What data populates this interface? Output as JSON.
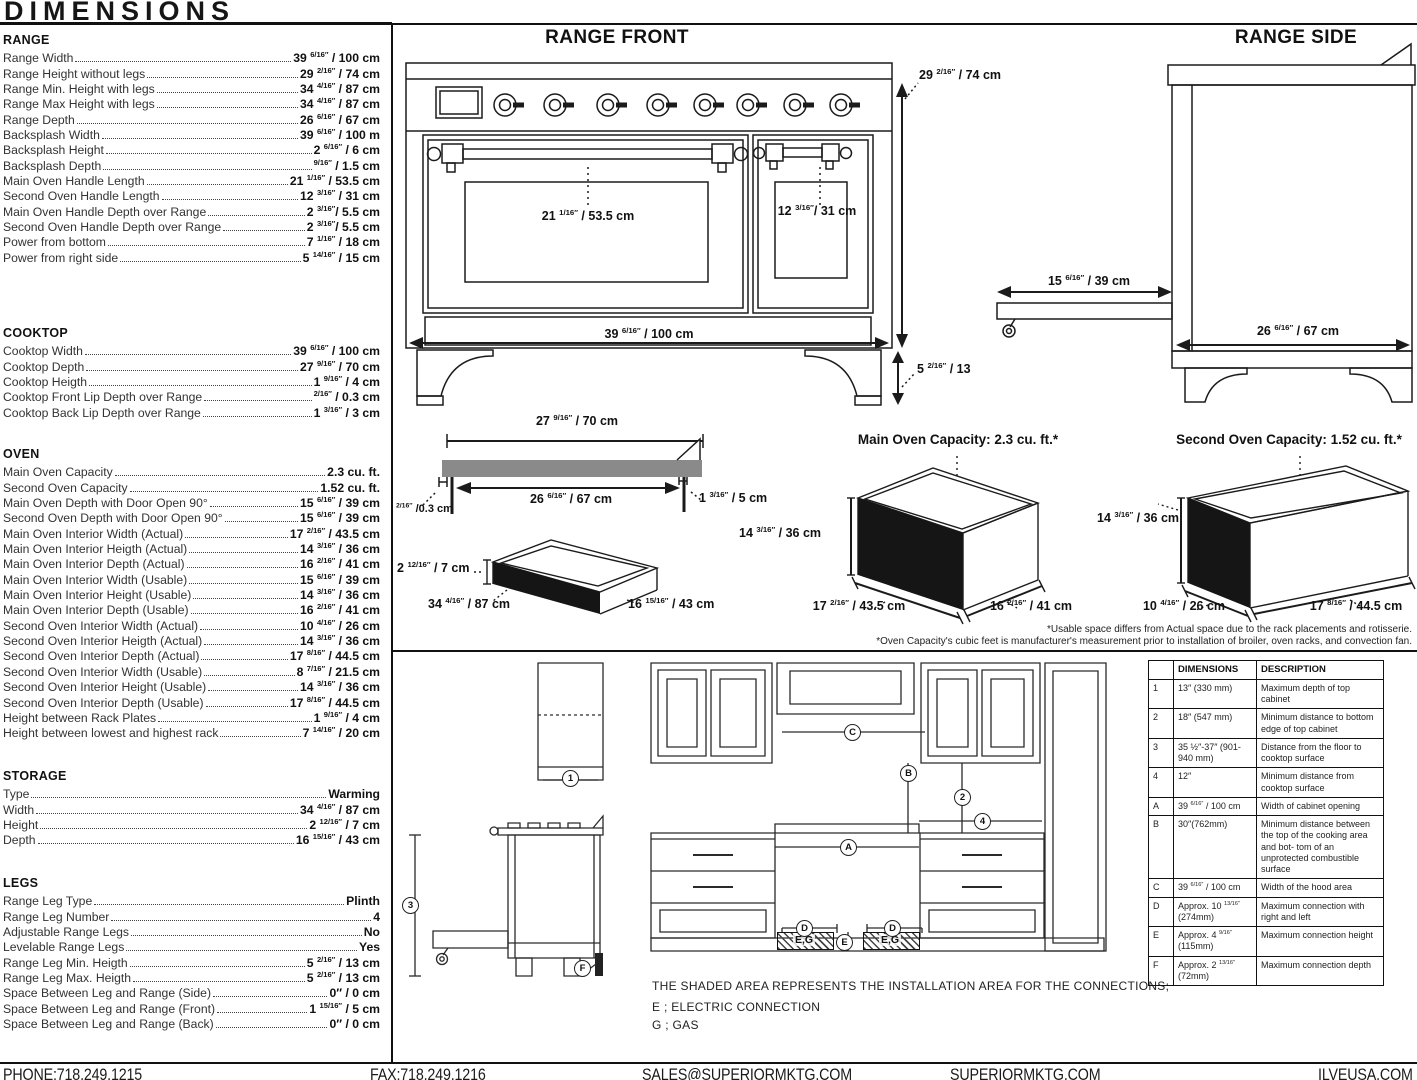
{
  "page": {
    "title": "DIMENSIONS"
  },
  "specs": {
    "sections": [
      {
        "title": "RANGE",
        "rows": [
          {
            "label": "Range Width",
            "value": "39 6/16″ / 100 cm"
          },
          {
            "label": "Range Height without legs",
            "value": "29 2/16″ / 74 cm"
          },
          {
            "label": "Range Min. Height with legs",
            "value": "34 4/16″ / 87 cm"
          },
          {
            "label": "Range Max Height with legs",
            "value": "34 4/16″ / 87 cm"
          },
          {
            "label": "Range Depth",
            "value": "26 6/16″ / 67 cm"
          },
          {
            "label": "Backsplash Width",
            "value": "39 6/16″ / 100 m"
          },
          {
            "label": "Backsplash Height",
            "value": "2 6/16″ / 6 cm"
          },
          {
            "label": "Backsplash Depth",
            "value": "9/16″ / 1.5 cm"
          },
          {
            "label": "Main Oven Handle Length",
            "value": "21 1/16″ / 53.5 cm"
          },
          {
            "label": "Second Oven Handle Length",
            "value": "12 3/16″ / 31 cm"
          },
          {
            "label": "Main Oven Handle Depth over Range",
            "value": "2 3/16″/ 5.5 cm"
          },
          {
            "label": "Second Oven Handle Depth over Range",
            "value": "2 3/16″/ 5.5 cm"
          },
          {
            "label": "Power from bottom",
            "value": "7 1/16″ / 18 cm"
          },
          {
            "label": "Power from right side",
            "value": "5 14/16″ / 15 cm"
          }
        ]
      },
      {
        "title": "COOKTOP",
        "rows": [
          {
            "label": "Cooktop Width",
            "value": "39 6/16″ / 100 cm"
          },
          {
            "label": "Cooktop Depth",
            "value": "27 9/16″ / 70 cm"
          },
          {
            "label": "Cooktop Heigth",
            "value": "1 9/16″ / 4 cm"
          },
          {
            "label": "Cooktop Front Lip Depth over Range",
            "value": "2/16″ / 0.3 cm"
          },
          {
            "label": "Cooktop Back Lip Depth over Range",
            "value": "1 3/16″ / 3 cm"
          }
        ]
      },
      {
        "title": "OVEN",
        "rows": [
          {
            "label": "Main Oven Capacity",
            "value": "2.3 cu. ft."
          },
          {
            "label": "Second Oven Capacity",
            "value": "1.52 cu. ft."
          },
          {
            "label": "Main Oven Depth with Door Open 90°",
            "value": "15 6/16″ / 39 cm"
          },
          {
            "label": "Second Oven Depth with Door Open 90°",
            "value": "15 6/16″ / 39 cm"
          },
          {
            "label": "Main Oven Interior Width (Actual)",
            "value": "17 2/16″ / 43.5 cm"
          },
          {
            "label": "Main Oven Interior Heigth (Actual)",
            "value": "14 3/16″ / 36 cm"
          },
          {
            "label": "Main Oven Interior Depth (Actual)",
            "value": "16 2/16″ / 41 cm"
          },
          {
            "label": "Main Oven Interior Width (Usable)",
            "value": "15 6/16″ / 39 cm"
          },
          {
            "label": "Main Oven Interior Height (Usable)",
            "value": "14 3/16″ / 36 cm"
          },
          {
            "label": "Main Oven Interior Depth (Usable)",
            "value": "16 2/16″ / 41 cm"
          },
          {
            "label": "Second Oven Interior Width (Actual)",
            "value": "10 4/16″ / 26 cm"
          },
          {
            "label": "Second Oven Interior Heigth (Actual)",
            "value": "14 3/16″ / 36 cm"
          },
          {
            "label": "Second Oven Interior Depth (Actual)",
            "value": "17 8/16″ / 44.5 cm"
          },
          {
            "label": "Second Oven Interior Width (Usable)",
            "value": "8 7/16″ / 21.5 cm"
          },
          {
            "label": "Second Oven Interior Height (Usable)",
            "value": "14 3/16″ / 36 cm"
          },
          {
            "label": "Second Oven Interior Depth (Usable)",
            "value": "17 8/16″ / 44.5 cm"
          },
          {
            "label": "Height between Rack Plates",
            "value": "1 9/16″ / 4 cm"
          },
          {
            "label": "Height between lowest and highest rack",
            "value": "7 14/16″ / 20 cm"
          }
        ]
      },
      {
        "title": "STORAGE",
        "rows": [
          {
            "label": "Type",
            "value": "Warming"
          },
          {
            "label": "Width",
            "value": "34 4/16″ / 87 cm"
          },
          {
            "label": "Height",
            "value": "2 12/16″ / 7 cm"
          },
          {
            "label": "Depth",
            "value": "16 15/16″ / 43 cm"
          }
        ]
      },
      {
        "title": "LEGS",
        "rows": [
          {
            "label": "Range Leg Type",
            "value": "Plinth"
          },
          {
            "label": "Range Leg Number",
            "value": "4"
          },
          {
            "label": "Adjustable Range Legs",
            "value": "No"
          },
          {
            "label": "Levelable Range Legs",
            "value": "Yes"
          },
          {
            "label": "Range Leg Min. Heigth",
            "value": "5 2/16″ / 13 cm"
          },
          {
            "label": "Range Leg Max. Heigth",
            "value": "5 2/16″ / 13 cm"
          },
          {
            "label": "Space Between Leg and Range (Side)",
            "value": "0″ / 0 cm"
          },
          {
            "label": "Space Between Leg and Range (Front)",
            "value": "1 15/16″ / 5 cm"
          },
          {
            "label": "Space Between Leg and Range (Back)",
            "value": "0″ / 0 cm"
          }
        ]
      }
    ]
  },
  "diagrams": {
    "range_front": {
      "title": "RANGE FRONT",
      "main_door_dim": "21 1/16″ / 53.5 cm",
      "second_door_dim": "12 3/16″/ 31 cm",
      "width_dim": "39 6/16″ / 100 cm",
      "height_dim": "29 2/16″ / 74 cm",
      "leg_dim": "5 2/16″ / 13"
    },
    "range_side": {
      "title": "RANGE SIDE",
      "drawer_dim": "15 6/16″ / 39 cm",
      "depth_dim": "26 6/16″ / 67 cm"
    },
    "cooktop": {
      "width_dim": "27 9/16″ / 70 cm",
      "inner_dim": "26 6/16″ / 67 cm",
      "front_lip_dim": "2/16″ /0.3 cm",
      "back_lip_dim": "1 3/16″ / 5 cm"
    },
    "storage": {
      "height_dim": "2 12/16″ / 7 cm",
      "width_dim": "34 4/16″ / 87 cm",
      "depth_dim": "16 15/16″ / 43 cm"
    },
    "main_oven": {
      "title": "Main Oven Capacity: 2.3 cu. ft.*",
      "height_dim": "14 3/16″ / 36 cm",
      "width_dim": "17 2/16″ / 43.5 cm",
      "depth_dim": "16 2/16″ / 41 cm"
    },
    "second_oven": {
      "title": "Second Oven Capacity: 1.52 cu. ft.*",
      "height_dim": "14 3/16″ / 36 cm",
      "width_dim": "10 4/16″ / 26 cm",
      "depth_dim": "17 8/16″ / 44.5 cm"
    },
    "footnote1": "*Usable space differs from Actual space due to the rack placements and rotisserie.",
    "footnote2": "*Oven Capacity's cubic feet is manufacturer's measurement prior to installation of broiler, oven racks, and convection fan."
  },
  "installation": {
    "note": "THE SHADED AREA REPRESENTS THE INSTALLATION AREA FOR THE CONNECTIONS;",
    "legend_e": "E ; ELECTRIC CONNECTION",
    "legend_g": "G ; GAS",
    "shaded_label": "E,G",
    "callouts": {
      "c1": "1",
      "c2": "2",
      "c3": "3",
      "c4": "4",
      "cA": "A",
      "cB": "B",
      "cC": "C",
      "cD": "D",
      "cE": "E",
      "cF": "F"
    }
  },
  "table": {
    "headers": {
      "id": "",
      "dim": "DIMENSIONS",
      "desc": "DESCRIPTION"
    },
    "rows": [
      {
        "id": "1",
        "dim": "13″ (330 mm)",
        "desc": "Maximum depth of top cabinet"
      },
      {
        "id": "2",
        "dim": "18″ (547 mm)",
        "desc": "Minimum distance to bottom edge of top cabinet"
      },
      {
        "id": "3",
        "dim": "35 ½″-37″ (901-940 mm)",
        "desc": "Distance from the floor to cooktop surface"
      },
      {
        "id": "4",
        "dim": "12″",
        "desc": "Minimum distance from cooktop surface"
      },
      {
        "id": "A",
        "dim": "39 6/16″ / 100 cm",
        "desc": "Width of cabinet opening"
      },
      {
        "id": "B",
        "dim": "30″(762mm)",
        "desc": "Minimum distance between the top of the cooking area and bot- tom of an unprotected combustible surface"
      },
      {
        "id": "C",
        "dim": "39 6/16″ / 100 cm",
        "desc": "Width of the hood area"
      },
      {
        "id": "D",
        "dim": "Approx. 10 13/16″ (274mm)",
        "desc": "Maximum connection with right and left"
      },
      {
        "id": "E",
        "dim": "Approx. 4 9/16″ (115mm)",
        "desc": "Maximum connection height"
      },
      {
        "id": "F",
        "dim": "Approx. 2 13/16″ (72mm)",
        "desc": "Maximum connection depth"
      }
    ]
  },
  "footer": {
    "phone": "PHONE:718.249.1215",
    "fax": "FAX:718.249.1216",
    "email": "SALES@SUPERIORMKTG.COM",
    "site": "SUPERIORMKTG.COM",
    "site2": "ILVEUSA.COM"
  },
  "colors": {
    "ink": "#1b1b1b",
    "cooktop_gray": "#8a8a8a",
    "fill_dark": "#151515"
  }
}
